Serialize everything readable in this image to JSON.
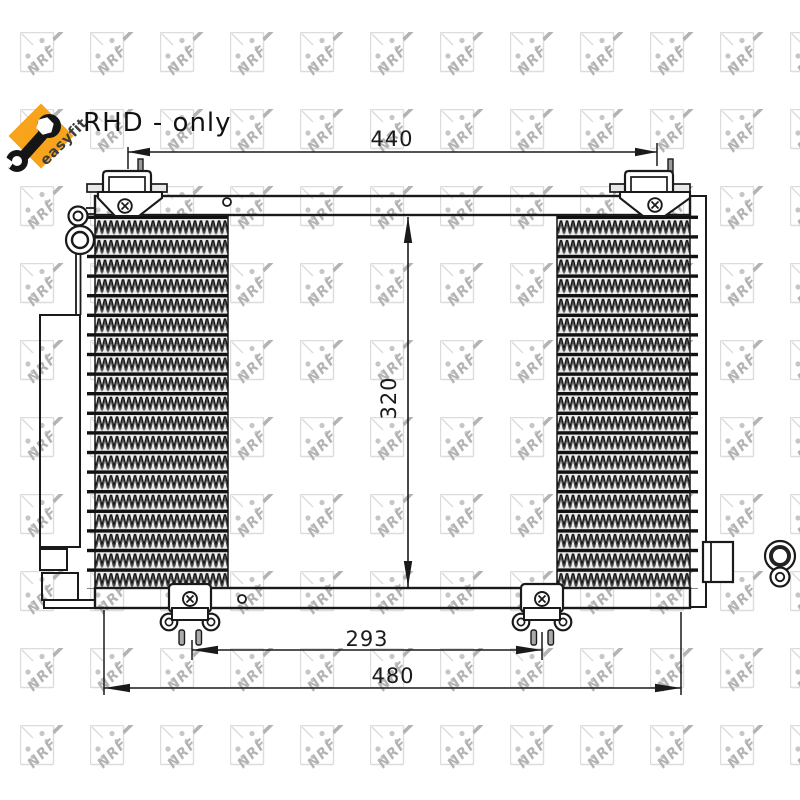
{
  "heading": {
    "text": "RHD - only"
  },
  "logo": {
    "easyfit_label": "easyfit",
    "diamond_color": "#F7A41C",
    "wrench_color": "#151515"
  },
  "watermark": {
    "brand": "NRF",
    "box_color": "#dcdcdc",
    "mark_color": "#b3b3b3"
  },
  "diagram": {
    "type": "technical-drawing",
    "part": "air-conditioning condenser",
    "dimensions": {
      "width_top": "440",
      "height": "320",
      "mount_spacing": "293",
      "width_bottom": "480"
    },
    "ink_color": "#1a1a1a"
  }
}
